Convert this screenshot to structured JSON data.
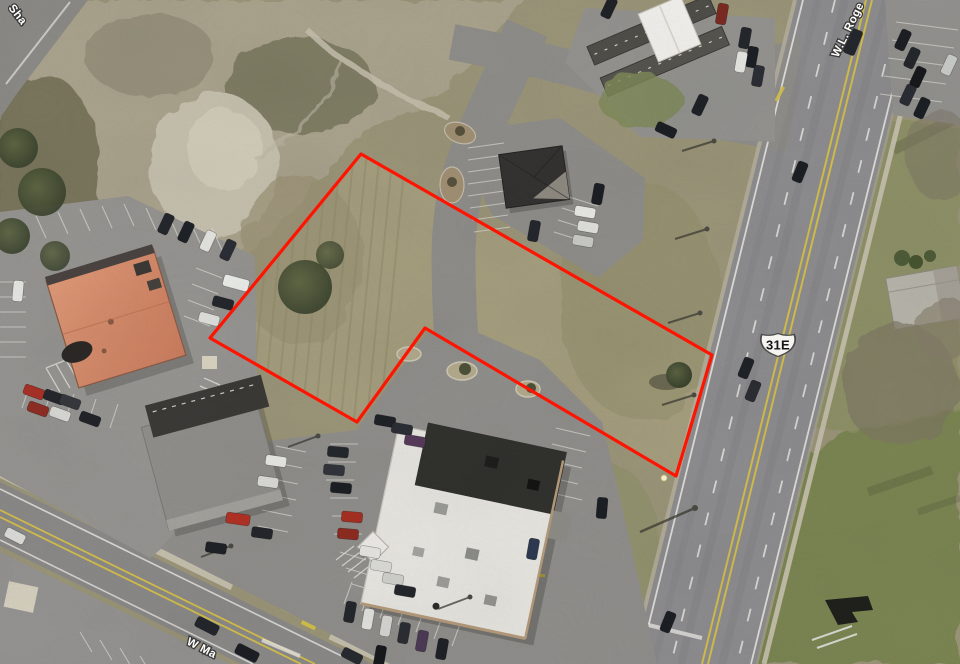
{
  "overlay": {
    "route_shield": {
      "text": "31E"
    },
    "road_labels": {
      "top_left": "Sha",
      "highway": "W.L. Roge",
      "bottom": "W Ma"
    },
    "parcel": {
      "points": "361,154 712,355 676,476 425,328 357,422 210,338",
      "color": "#fe1400",
      "stroke_width": 3.2,
      "corner_marker": {
        "x": 664,
        "y": 478
      }
    }
  },
  "palette": {
    "asphalt_road": "#8d8c8e",
    "asphalt_lot": "#8f8e8b",
    "concrete": "#c9c3b1",
    "grass_scrub": "#a49d7d",
    "grass_green": "#79854f",
    "dirt": "#c6c0ae",
    "roof_orange": "#d2896d",
    "roof_white": "#e7e5e0",
    "roof_dark": "#343230",
    "roof_gray": "#8f8e8a",
    "lane_yellow": "#d3be4a",
    "lane_white": "#e6e5e1"
  },
  "vehicles": [
    {
      "x": 166,
      "y": 224,
      "r": 115,
      "c": "#23262b"
    },
    {
      "x": 186,
      "y": 232,
      "r": 115,
      "c": "#1e2126"
    },
    {
      "x": 208,
      "y": 241,
      "r": 115,
      "c": "#e4e4e0"
    },
    {
      "x": 228,
      "y": 250,
      "r": 115,
      "c": "#2a2d33"
    },
    {
      "x": 236,
      "y": 283,
      "r": 15,
      "c": "#eceeea",
      "l": 26,
      "w": 12
    },
    {
      "x": 223,
      "y": 303,
      "r": 15,
      "c": "#23262b"
    },
    {
      "x": 209,
      "y": 319,
      "r": 15,
      "c": "#dedfdb"
    },
    {
      "x": 18,
      "y": 291,
      "r": 95,
      "c": "#e6e6e2"
    },
    {
      "x": 34,
      "y": 392,
      "r": 20,
      "c": "#a83026"
    },
    {
      "x": 54,
      "y": 397,
      "r": 20,
      "c": "#23262b"
    },
    {
      "x": 70,
      "y": 402,
      "r": 20,
      "c": "#34373c"
    },
    {
      "x": 38,
      "y": 409,
      "r": 20,
      "c": "#8f2d24"
    },
    {
      "x": 60,
      "y": 414,
      "r": 20,
      "c": "#d9d9d5"
    },
    {
      "x": 90,
      "y": 419,
      "r": 20,
      "c": "#202328"
    },
    {
      "x": 15,
      "y": 536,
      "r": 27,
      "c": "#dcdcd8"
    },
    {
      "x": 207,
      "y": 626,
      "r": 27,
      "c": "#23262b",
      "l": 24,
      "w": 11
    },
    {
      "x": 247,
      "y": 653,
      "r": 27,
      "c": "#1b1e23",
      "l": 24,
      "w": 11
    },
    {
      "x": 352,
      "y": 656,
      "r": 27,
      "c": "#26292e"
    },
    {
      "x": 585,
      "y": 212,
      "r": 10,
      "c": "#e8e8e4"
    },
    {
      "x": 588,
      "y": 227,
      "r": 10,
      "c": "#dfdfdb"
    },
    {
      "x": 583,
      "y": 241,
      "r": 10,
      "c": "#c9c9c5"
    },
    {
      "x": 534,
      "y": 231,
      "r": 100,
      "c": "#23262b"
    },
    {
      "x": 598,
      "y": 194,
      "r": 100,
      "c": "#1b1e23"
    },
    {
      "x": 609,
      "y": 8,
      "r": 115,
      "c": "#1e2126"
    },
    {
      "x": 722,
      "y": 14,
      "r": 100,
      "c": "#7a2a22"
    },
    {
      "x": 745,
      "y": 38,
      "r": 100,
      "c": "#23262b"
    },
    {
      "x": 752,
      "y": 57,
      "r": 100,
      "c": "#1b1e23"
    },
    {
      "x": 758,
      "y": 76,
      "r": 100,
      "c": "#2a2d33"
    },
    {
      "x": 741,
      "y": 62,
      "r": 100,
      "c": "#e4e4e0"
    },
    {
      "x": 700,
      "y": 105,
      "r": 115,
      "c": "#1e2126"
    },
    {
      "x": 666,
      "y": 130,
      "r": 25,
      "c": "#1b1e23"
    },
    {
      "x": 853,
      "y": 42,
      "r": -68,
      "c": "#23262b",
      "l": 26,
      "w": 12
    },
    {
      "x": 800,
      "y": 172,
      "r": -68,
      "c": "#1b1e23"
    },
    {
      "x": 746,
      "y": 368,
      "r": -68,
      "c": "#1e2126"
    },
    {
      "x": 753,
      "y": 391,
      "r": -68,
      "c": "#2a2d33"
    },
    {
      "x": 668,
      "y": 622,
      "r": -68,
      "c": "#1b1e23"
    },
    {
      "x": 903,
      "y": 40,
      "r": 115,
      "c": "#1b1e23"
    },
    {
      "x": 912,
      "y": 58,
      "r": 115,
      "c": "#23262b"
    },
    {
      "x": 918,
      "y": 77,
      "r": 115,
      "c": "#16181c"
    },
    {
      "x": 908,
      "y": 95,
      "r": 115,
      "c": "#2a2d33"
    },
    {
      "x": 922,
      "y": 108,
      "r": 115,
      "c": "#1b1e23"
    },
    {
      "x": 949,
      "y": 65,
      "r": 115,
      "c": "#caccc8"
    },
    {
      "x": 385,
      "y": 421,
      "r": 10,
      "c": "#1e2126"
    },
    {
      "x": 402,
      "y": 429,
      "r": 10,
      "c": "#2a2d33"
    },
    {
      "x": 415,
      "y": 441,
      "r": 10,
      "c": "#56395a"
    },
    {
      "x": 338,
      "y": 452,
      "r": 5,
      "c": "#23262b"
    },
    {
      "x": 334,
      "y": 470,
      "r": 5,
      "c": "#31343a"
    },
    {
      "x": 341,
      "y": 488,
      "r": 5,
      "c": "#1b1e23"
    },
    {
      "x": 352,
      "y": 517,
      "r": 5,
      "c": "#a52e22"
    },
    {
      "x": 348,
      "y": 534,
      "r": 5,
      "c": "#8e2b20"
    },
    {
      "x": 370,
      "y": 552,
      "r": 10,
      "c": "#e4e4e0"
    },
    {
      "x": 381,
      "y": 566,
      "r": 10,
      "c": "#dadad6"
    },
    {
      "x": 393,
      "y": 579,
      "r": 10,
      "c": "#cfcfcb"
    },
    {
      "x": 405,
      "y": 591,
      "r": 10,
      "c": "#23262b"
    },
    {
      "x": 350,
      "y": 612,
      "r": 100,
      "c": "#23262b"
    },
    {
      "x": 368,
      "y": 619,
      "r": 100,
      "c": "#e2e2de"
    },
    {
      "x": 386,
      "y": 626,
      "r": 100,
      "c": "#d6d6d2"
    },
    {
      "x": 404,
      "y": 633,
      "r": 100,
      "c": "#2a2d33"
    },
    {
      "x": 422,
      "y": 641,
      "r": 100,
      "c": "#4c3a55"
    },
    {
      "x": 442,
      "y": 649,
      "r": 100,
      "c": "#1e2126"
    },
    {
      "x": 380,
      "y": 656,
      "r": 100,
      "c": "#16181c"
    },
    {
      "x": 533,
      "y": 549,
      "r": 100,
      "c": "#2c3850"
    },
    {
      "x": 602,
      "y": 508,
      "r": 95,
      "c": "#1b1e23"
    },
    {
      "x": 276,
      "y": 461,
      "r": 8,
      "c": "#e8e8e4"
    },
    {
      "x": 268,
      "y": 482,
      "r": 8,
      "c": "#dcdcd8"
    },
    {
      "x": 238,
      "y": 519,
      "r": 8,
      "c": "#b23124",
      "l": 24,
      "w": 11
    },
    {
      "x": 262,
      "y": 533,
      "r": 8,
      "c": "#23262b"
    },
    {
      "x": 216,
      "y": 548,
      "r": 8,
      "c": "#1e2126"
    }
  ]
}
